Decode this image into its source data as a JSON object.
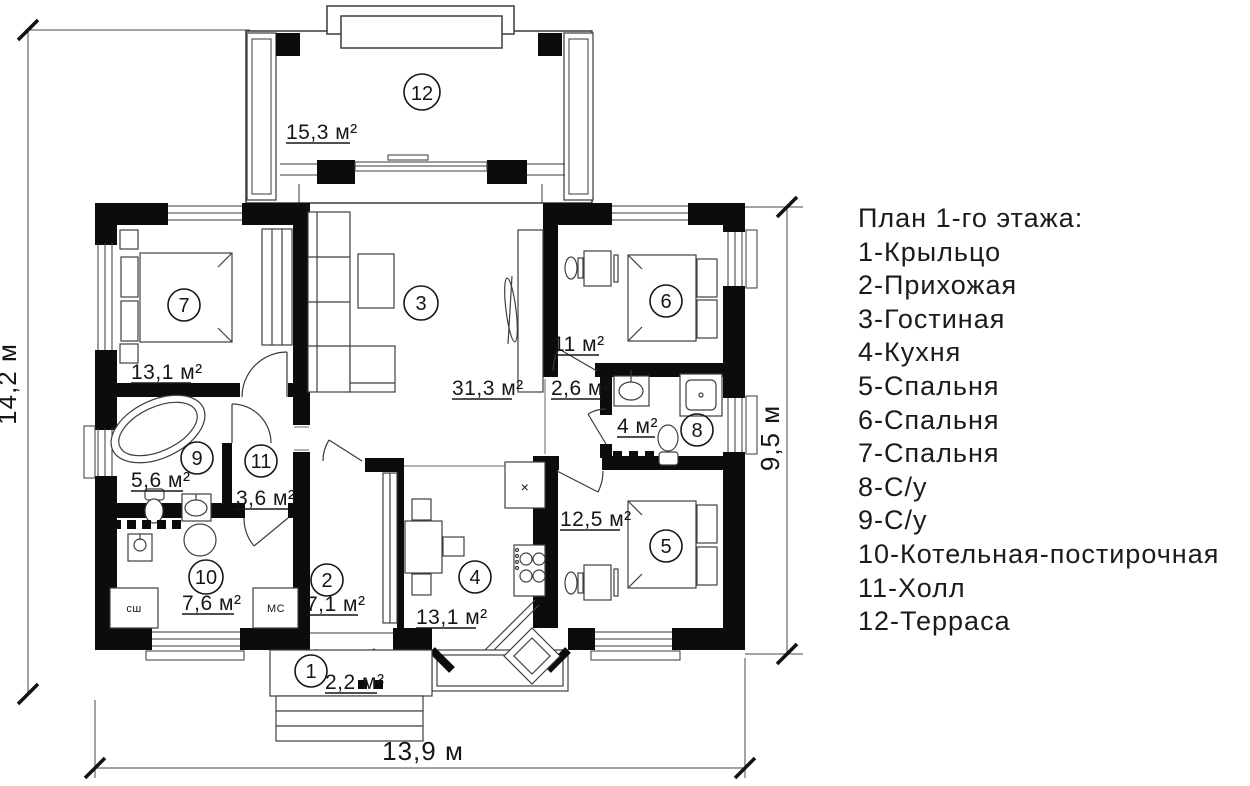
{
  "legend": {
    "title": "План 1-го этажа:",
    "items": [
      "1-Крыльцо",
      "2-Прихожая",
      "3-Гостиная",
      "4-Кухня",
      "5-Спальня",
      "6-Спальня",
      "7-Спальня",
      "8-С/у",
      "9-С/у",
      "10-Котельная-постирочная",
      "11-Холл",
      "12-Терраса"
    ]
  },
  "dimensions": {
    "left": "14,2 м",
    "right": "9,5 м",
    "bottom": "13,9 м"
  },
  "rooms": [
    {
      "number": "1",
      "area": "2,2 м²"
    },
    {
      "number": "2",
      "area": "7,1 м²"
    },
    {
      "number": "3",
      "area": "31,3 м²"
    },
    {
      "number": "4",
      "area": "13,1 м²"
    },
    {
      "number": "5",
      "area": "12,5 м²"
    },
    {
      "number": "6",
      "area": "11 м²"
    },
    {
      "number": "7",
      "area": "13,1 м²"
    },
    {
      "number": "8",
      "area": "4 м²"
    },
    {
      "number": "9",
      "area": "5,6 м²"
    },
    {
      "number": "10",
      "area": "7,6 м²"
    },
    {
      "number": "11",
      "area": "3,6 м²"
    },
    {
      "number": "12",
      "area": "15,3 м²"
    }
  ],
  "unlabeled_area": "2,6 м²",
  "appliance_labels": {
    "dryer": "сш",
    "washer": "МС",
    "hood_mark": "×"
  },
  "colors": {
    "walls": "#0c0c0c",
    "lines": "#3a3a3a",
    "text": "#161616",
    "background": "#ffffff"
  }
}
